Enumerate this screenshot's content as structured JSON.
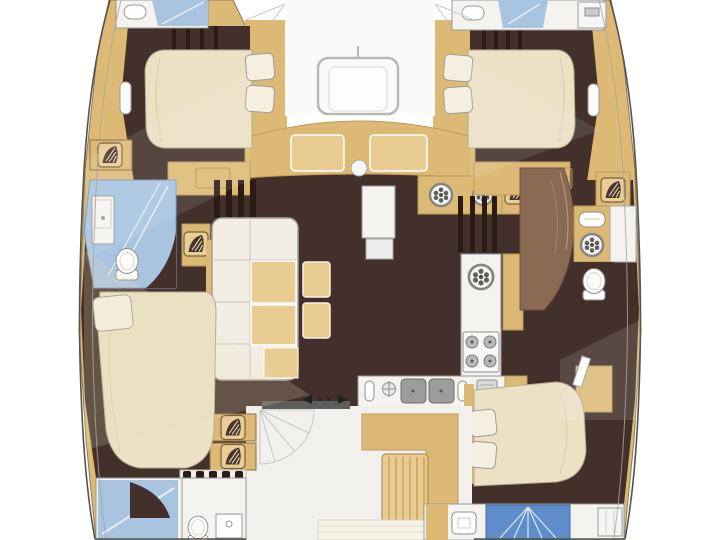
{
  "meta": {
    "title": "Catamaran yacht interior floor plan, top-down view",
    "type": "floorplan-diagram"
  },
  "colors": {
    "background": "#ffffff",
    "hullWood": "#dcba76",
    "woodLight": "#e8cc92",
    "woodStripe": "#c9a35e",
    "floorDark": "#44302a",
    "floorDarker": "#2c1b15",
    "bedCream": "#ece0c5",
    "bedHighlight": "#f5efe0",
    "bathBlue": "#a9c4e0",
    "showerBlue": "#5f8dc9",
    "counterWhite": "#f4f3f0",
    "cockpitFloor": "#f1f0ec",
    "applianceGray": "#b9b9b7",
    "applianceDark": "#8e8e8c",
    "outline": "#56524c",
    "lightLine": "#cbcac6",
    "wardrobeBrown": "#8a6a52"
  },
  "rooms": [
    {
      "id": "foredeck-cockpit",
      "label": "forward cockpit with table and curved bench"
    },
    {
      "id": "port-forward-cabin",
      "label": "port forward cabin with double berth"
    },
    {
      "id": "port-mid-bathroom",
      "label": "port bathroom with sink and toilet"
    },
    {
      "id": "port-aft-cabin",
      "label": "port aft cabin with double berth"
    },
    {
      "id": "port-aft-bathroom",
      "label": "port aft shower room with toilet and sink"
    },
    {
      "id": "salon",
      "label": "salon with L-shaped sofa and stools"
    },
    {
      "id": "galley",
      "label": "galley with stove, double sink and counters"
    },
    {
      "id": "starboard-forward-cabin",
      "label": "starboard forward cabin with double berth"
    },
    {
      "id": "starboard-mid-bathroom",
      "label": "starboard bathroom with sink, shower and toilet"
    },
    {
      "id": "starboard-aft-cabin",
      "label": "starboard aft cabin with double berth"
    },
    {
      "id": "starboard-aft-bathroom",
      "label": "starboard aft shower room"
    },
    {
      "id": "aft-cockpit",
      "label": "aft cockpit with L-bench, table and deck hatches"
    }
  ],
  "fixtures": [
    "deck-hatch-icon",
    "round-dial-icon",
    "toilet-icon",
    "sink-icon",
    "double-sink-icon",
    "stove-icon",
    "cockpit-table",
    "sliding-door-arrows",
    "companionway-steps",
    "shower-glass",
    "bed-pillow",
    "stair-fan"
  ]
}
